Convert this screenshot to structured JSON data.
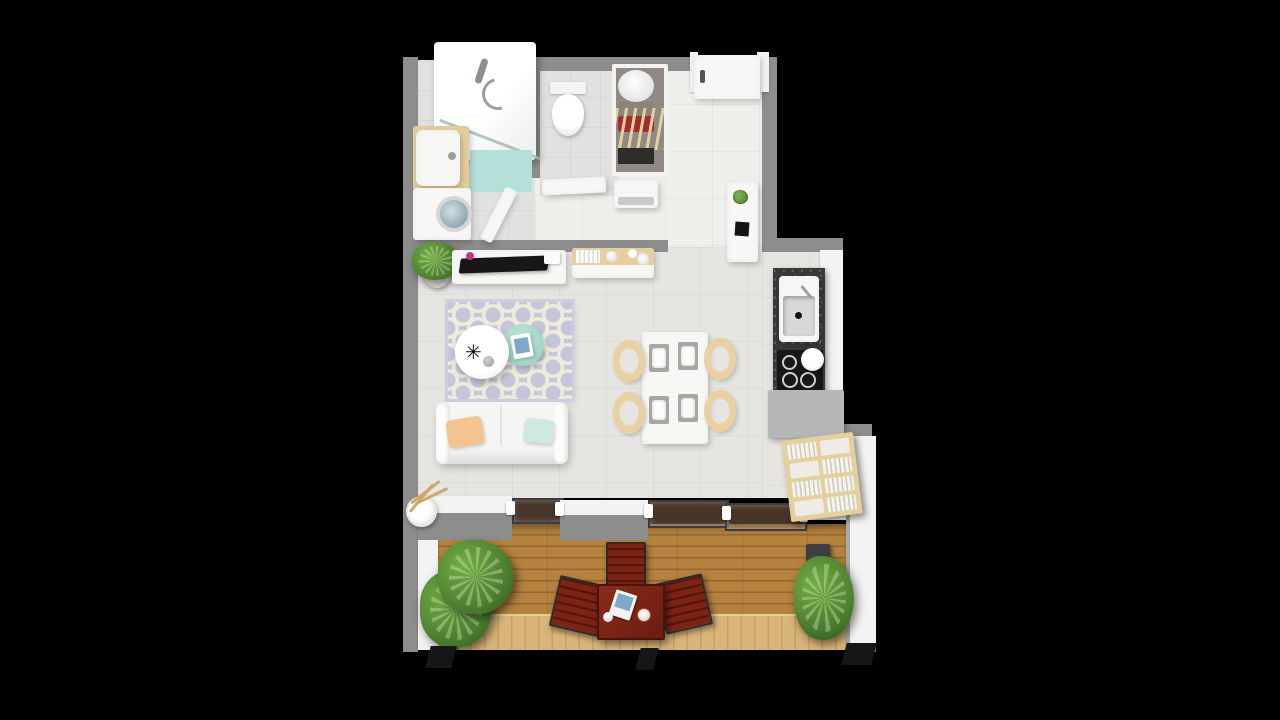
{
  "scene": {
    "type": "3d-apartment-floor-plan-top-view",
    "background": "black",
    "rooms": [
      {
        "name": "bathroom",
        "furniture": [
          "shower-enclosure",
          "shower-head",
          "glass-screen",
          "bath-mat",
          "vanity-sink",
          "washing-machine"
        ]
      },
      {
        "name": "wc",
        "furniture": [
          "toilet",
          "wc-door"
        ]
      },
      {
        "name": "entry-hall",
        "furniture": [
          "front-door",
          "open-wardrobe",
          "basket",
          "hanging-clothes",
          "shoe-cabinet",
          "open-bathroom-door"
        ]
      },
      {
        "name": "kitchen",
        "furniture": [
          "tall-cabinet",
          "plant-small",
          "sink-counter",
          "cooktop",
          "base-cabinet",
          "cube-bookshelf"
        ]
      },
      {
        "name": "living-dining",
        "furniture": [
          "potted-plant",
          "tv-stand",
          "tv",
          "sideboard",
          "trellis-rug",
          "round-coffee-table",
          "mint-side-table",
          "sofa",
          "pillow-orange",
          "pillow-mint",
          "dining-table",
          "dining-chairs",
          "place-settings",
          "vase-with-branches"
        ]
      },
      {
        "name": "balcony",
        "furniture": [
          "sliding-glass-doors",
          "wood-deck",
          "plant-large-left",
          "plant-right",
          "planter-box",
          "outdoor-table",
          "outdoor-chairs",
          "magazine",
          "cups"
        ]
      }
    ]
  },
  "icons": {
    "starburst": "✳"
  },
  "palette": {
    "background": "#000000",
    "wall_gray": "#8d8d8d",
    "wall_white": "#f3f3f2",
    "floor_main": "#e6e5e2",
    "floor_hall": "#efefec",
    "floor_bath": "#e2e1df",
    "furn_white": "#f7f7f6",
    "teal_mat": "#b5e0da",
    "rug_base": "#c6c6da",
    "rug_pattern": "#efecdc",
    "sofa_white": "#f5f5f4",
    "pillow_orange": "#f3c48f",
    "pillow_mint": "#cfe8e0",
    "wood_light": "#e6cf9f",
    "wood_chair": "#e9d1a1",
    "wood_deck": "#b5823f",
    "wood_deck_gap": "#96672e",
    "wood_deck_light": "#d9b57a",
    "wood_deck_light_gap": "#c59f63",
    "outdoor_mahogany": "#7b2416",
    "plant_green": "#4a7a2e",
    "plant_light": "#74ae46",
    "granite": "#38383a",
    "appliance_black": "#171717",
    "glass_tint": "rgba(158,118,88,0.45)",
    "mint_table": "#c0e7de",
    "book_blue": "#7fa8c9",
    "accent_pink": "#c0368b"
  }
}
